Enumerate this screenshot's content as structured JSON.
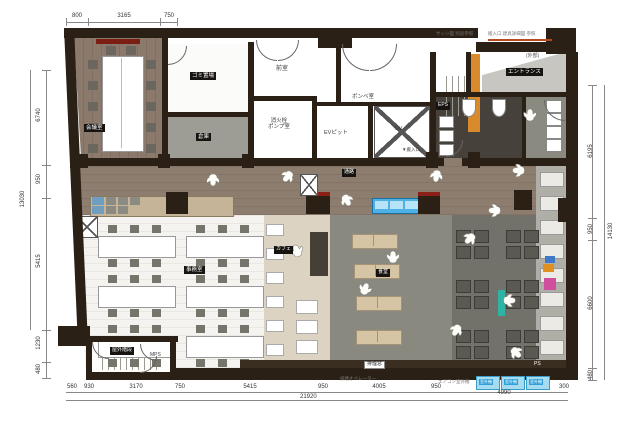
{
  "rooms": {
    "meeting": "会議室",
    "garbage": "ゴミ置場",
    "storage": "倉庫",
    "anteroom": "前室",
    "cylinder": "ボンベ室",
    "fire1": "消火栓",
    "fire2": "ポンプ室",
    "ev_pit": "EVピット",
    "ev": "EV",
    "entrance": "エントランス",
    "exterior": "(外部)",
    "eps": "EPS",
    "ps": "PS",
    "mps": "MPS",
    "corridor": "通路",
    "office": "事務室",
    "cafe": "カフェ",
    "dining": "食堂",
    "outdoor_stairs": "屋外階段",
    "smoke_window": "排煙窓",
    "smoke_operator": "排煙オペレーター",
    "delivery": "▼搬入口",
    "ac_label": "エアコン室外機",
    "ac_unit": "室外機"
  },
  "notes": {
    "note1": "サッシ図 別途参照",
    "note2": "搬入口 建具詳細図 参照"
  },
  "dimensions": {
    "top": [
      "800",
      "3165",
      "750"
    ],
    "left": [
      "6740",
      "950",
      "5415",
      "1230",
      "480"
    ],
    "left_total": "13030",
    "right": [
      "6195",
      "950",
      "6600",
      "480"
    ],
    "right_total": "14130",
    "bottom": [
      "560",
      "930",
      "3170",
      "750",
      "5415",
      "950",
      "4005",
      "950",
      "4990",
      "300"
    ],
    "bottom_total": "21920"
  },
  "figures": [
    [
      213,
      180,
      0
    ],
    [
      286,
      176,
      40
    ],
    [
      348,
      200,
      -30
    ],
    [
      436,
      176,
      10
    ],
    [
      516,
      168,
      90
    ],
    [
      393,
      252,
      180
    ],
    [
      366,
      284,
      200
    ],
    [
      296,
      246,
      160
    ],
    [
      492,
      208,
      90
    ],
    [
      468,
      238,
      45
    ],
    [
      512,
      298,
      270
    ],
    [
      518,
      352,
      315
    ],
    [
      530,
      110,
      180
    ],
    [
      455,
      330,
      30
    ]
  ],
  "colors": {
    "wall": "#2a2015",
    "wood": "#8d7d6f",
    "lounge": "#8a897f",
    "kitchen": "#73726a",
    "accent_blue": "#4fb0e4",
    "accent_teal": "#2fb3a3",
    "accent_orange": "#d98a2c"
  }
}
